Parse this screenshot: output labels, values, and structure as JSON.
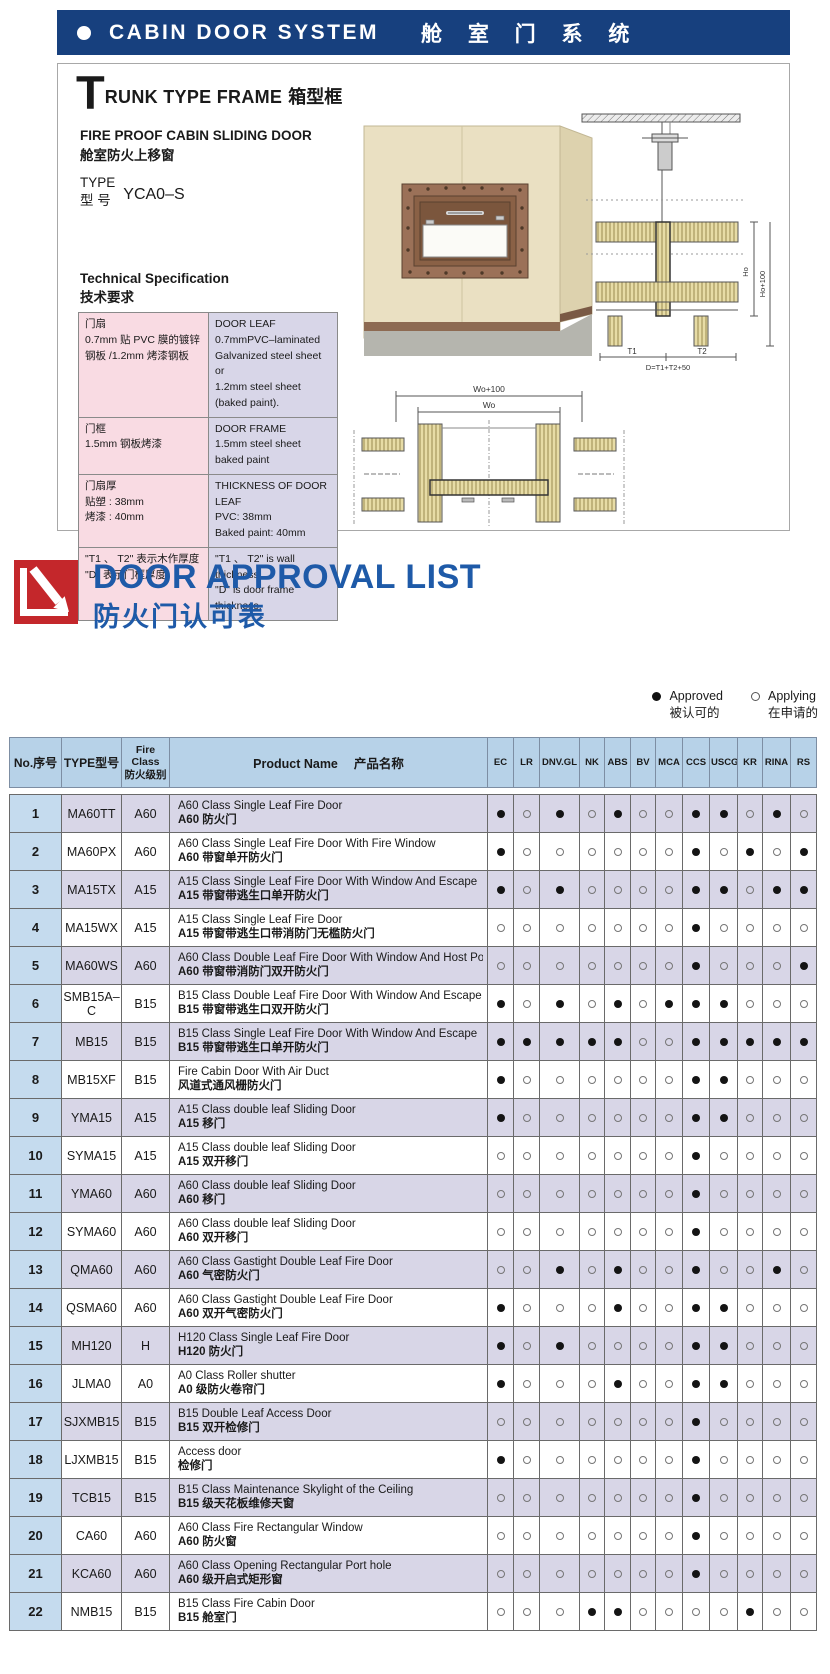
{
  "banner": {
    "title_en": "CABIN DOOR SYSTEM",
    "title_zh": "舱 室 门 系 统"
  },
  "trunk_section": {
    "title_initial": "T",
    "title_rest": "RUNK TYPE FRAME",
    "title_zh": "箱型框",
    "subtitle": "FIRE PROOF CABIN SLIDING DOOR\n舱室防火上移窗",
    "type_label": "TYPE\n型  号",
    "type_value": "YCA0–S",
    "tech_title": "Technical Specification\n技术要求",
    "spec_rows": [
      {
        "zh": "门扇\n0.7mm 贴 PVC 膜的镀锌\n钢板 /1.2mm 烤漆钢板",
        "en": "DOOR LEAF\n0.7mmPVC–laminated\nGalvanized steel sheet or\n1.2mm steel sheet\n(baked paint)."
      },
      {
        "zh": "门框\n1.5mm 钢板烤漆",
        "en": "DOOR FRAME\n1.5mm steel sheet baked paint"
      },
      {
        "zh": "门扇厚\n贴塑 : 38mm\n烤漆 : 40mm",
        "en": "THICKNESS OF DOOR LEAF\nPVC: 38mm\nBaked paint: 40mm"
      },
      {
        "zh": "\"T1 、 T2\" 表示木作厚度\n\"D\" 表示门框厚度",
        "en": "\"T1 、 T2\" is wall thickness;\n\"D\" is door frame thickness."
      }
    ],
    "drawing_labels": {
      "ho": "Ho",
      "ho_plus": "Ho+100",
      "t1": "T1",
      "t2": "T2",
      "d_formula": "D=T1+T2+50",
      "wo_plus": "Wo+100",
      "wo": "Wo"
    }
  },
  "approval_section": {
    "title_en": "DOOR APPROVAL LIST",
    "title_zh": "防火门认可表",
    "legend": {
      "approved_en": "Approved",
      "approved_zh": "被认可的",
      "applying_en": "Applying",
      "applying_zh": "在申请的"
    },
    "table": {
      "header_no": "No.序号",
      "header_type": "TYPE型号",
      "header_fire_class": "Fire\nClass\n防火级别",
      "header_product": "Product Name　 产品名称",
      "societies": [
        "EC",
        "LR",
        "DNV.GL",
        "NK",
        "ABS",
        "BV",
        "MCA",
        "CCS",
        "USCG",
        "KR",
        "RINA",
        "RS"
      ],
      "rows": [
        {
          "no": "1",
          "type": "MA60TT",
          "fire_class": "A60",
          "name_en": "A60 Class Single Leaf Fire Door",
          "name_zh": "A60 防火门",
          "approvals": [
            1,
            0,
            1,
            0,
            1,
            0,
            0,
            1,
            1,
            0,
            1,
            0
          ]
        },
        {
          "no": "2",
          "type": "MA60PX",
          "fire_class": "A60",
          "name_en": "A60 Class Single Leaf Fire Door With Fire Window",
          "name_zh": "A60 带窗单开防火门",
          "approvals": [
            1,
            0,
            0,
            0,
            0,
            0,
            0,
            1,
            0,
            1,
            0,
            1
          ]
        },
        {
          "no": "3",
          "type": "MA15TX",
          "fire_class": "A15",
          "name_en": "A15 Class Single Leaf Fire Door With Window And Escape",
          "name_zh": "A15 带窗带逃生口单开防火门",
          "approvals": [
            1,
            0,
            1,
            0,
            0,
            0,
            0,
            1,
            1,
            0,
            1,
            1
          ]
        },
        {
          "no": "4",
          "type": "MA15WX",
          "fire_class": "A15",
          "name_en": "A15 Class Single Leaf Fire Door",
          "name_zh": "A15 带窗带逃生口带消防门无槛防火门",
          "approvals": [
            0,
            0,
            0,
            0,
            0,
            0,
            0,
            1,
            0,
            0,
            0,
            0
          ]
        },
        {
          "no": "5",
          "type": "MA60WS",
          "fire_class": "A60",
          "name_en": "A60 Class Double Leaf Fire Door With Window And Host Port",
          "name_zh": "A60 带窗带消防门双开防火门",
          "approvals": [
            0,
            0,
            0,
            0,
            0,
            0,
            0,
            1,
            0,
            0,
            0,
            1
          ]
        },
        {
          "no": "6",
          "type": "SMB15A–C",
          "fire_class": "B15",
          "name_en": "B15 Class Double Leaf Fire Door With Window And Escape",
          "name_zh": "B15 带窗带逃生口双开防火门",
          "approvals": [
            1,
            0,
            1,
            0,
            1,
            0,
            1,
            1,
            1,
            0,
            0,
            0
          ]
        },
        {
          "no": "7",
          "type": "MB15",
          "fire_class": "B15",
          "name_en": "B15 Class Single Leaf Fire Door With Window And Escape",
          "name_zh": "B15 带窗带逃生口单开防火门",
          "approvals": [
            1,
            1,
            1,
            1,
            1,
            0,
            0,
            1,
            1,
            1,
            1,
            1
          ]
        },
        {
          "no": "8",
          "type": "MB15XF",
          "fire_class": "B15",
          "name_en": "Fire Cabin Door With Air Duct",
          "name_zh": "风道式通风栅防火门",
          "approvals": [
            1,
            0,
            0,
            0,
            0,
            0,
            0,
            1,
            1,
            0,
            0,
            0
          ]
        },
        {
          "no": "9",
          "type": "YMA15",
          "fire_class": "A15",
          "name_en": "A15 Class double leaf Sliding Door",
          "name_zh": "A15 移门",
          "approvals": [
            1,
            0,
            0,
            0,
            0,
            0,
            0,
            1,
            1,
            0,
            0,
            0
          ]
        },
        {
          "no": "10",
          "type": "SYMA15",
          "fire_class": "A15",
          "name_en": "A15 Class double leaf Sliding Door",
          "name_zh": "A15 双开移门",
          "approvals": [
            0,
            0,
            0,
            0,
            0,
            0,
            0,
            1,
            0,
            0,
            0,
            0
          ]
        },
        {
          "no": "11",
          "type": "YMA60",
          "fire_class": "A60",
          "name_en": "A60 Class double leaf Sliding Door",
          "name_zh": "A60 移门",
          "approvals": [
            0,
            0,
            0,
            0,
            0,
            0,
            0,
            1,
            0,
            0,
            0,
            0
          ]
        },
        {
          "no": "12",
          "type": "SYMA60",
          "fire_class": "A60",
          "name_en": "A60 Class double leaf Sliding Door",
          "name_zh": "A60 双开移门",
          "approvals": [
            0,
            0,
            0,
            0,
            0,
            0,
            0,
            1,
            0,
            0,
            0,
            0
          ]
        },
        {
          "no": "13",
          "type": "QMA60",
          "fire_class": "A60",
          "name_en": "A60 Class Gastight Double Leaf Fire Door",
          "name_zh": "A60 气密防火门",
          "approvals": [
            0,
            0,
            1,
            0,
            1,
            0,
            0,
            1,
            0,
            0,
            1,
            0
          ]
        },
        {
          "no": "14",
          "type": "QSMA60",
          "fire_class": "A60",
          "name_en": "A60 Class Gastight Double Leaf Fire Door",
          "name_zh": "A60 双开气密防火门",
          "approvals": [
            1,
            0,
            0,
            0,
            1,
            0,
            0,
            1,
            1,
            0,
            0,
            0
          ]
        },
        {
          "no": "15",
          "type": "MH120",
          "fire_class": "H",
          "name_en": "H120 Class Single Leaf Fire Door",
          "name_zh": "H120 防火门",
          "approvals": [
            1,
            0,
            1,
            0,
            0,
            0,
            0,
            1,
            1,
            0,
            0,
            0
          ]
        },
        {
          "no": "16",
          "type": "JLMA0",
          "fire_class": "A0",
          "name_en": "A0 Class Roller shutter",
          "name_zh": "A0 级防火卷帘门",
          "approvals": [
            1,
            0,
            0,
            0,
            1,
            0,
            0,
            1,
            1,
            0,
            0,
            0
          ]
        },
        {
          "no": "17",
          "type": "SJXMB15",
          "fire_class": "B15",
          "name_en": "B15  Double Leaf Access Door",
          "name_zh": "B15 双开检修门",
          "approvals": [
            0,
            0,
            0,
            0,
            0,
            0,
            0,
            1,
            0,
            0,
            0,
            0
          ]
        },
        {
          "no": "18",
          "type": "LJXMB15",
          "fire_class": "B15",
          "name_en": "Access door",
          "name_zh": "检修门",
          "approvals": [
            1,
            0,
            0,
            0,
            0,
            0,
            0,
            1,
            0,
            0,
            0,
            0
          ]
        },
        {
          "no": "19",
          "type": "TCB15",
          "fire_class": "B15",
          "name_en": "B15 Class Maintenance Skylight of the Ceiling",
          "name_zh": "B15 级天花板维修天窗",
          "approvals": [
            0,
            0,
            0,
            0,
            0,
            0,
            0,
            1,
            0,
            0,
            0,
            0
          ]
        },
        {
          "no": "20",
          "type": "CA60",
          "fire_class": "A60",
          "name_en": "A60 Class Fire Rectangular Window",
          "name_zh": "A60 防火窗",
          "approvals": [
            0,
            0,
            0,
            0,
            0,
            0,
            0,
            1,
            0,
            0,
            0,
            0
          ]
        },
        {
          "no": "21",
          "type": "KCA60",
          "fire_class": "A60",
          "name_en": "A60 Class  Opening Rectangular Port hole",
          "name_zh": "A60 级开启式矩形窗",
          "approvals": [
            0,
            0,
            0,
            0,
            0,
            0,
            0,
            1,
            0,
            0,
            0,
            0
          ]
        },
        {
          "no": "22",
          "type": "NMB15",
          "fire_class": "B15",
          "name_en": "B15 Class Fire Cabin Door",
          "name_zh": "B15 舱室门",
          "approvals": [
            0,
            0,
            0,
            1,
            1,
            0,
            0,
            0,
            0,
            1,
            0,
            0
          ]
        }
      ]
    }
  },
  "colors": {
    "banner_blue": "#17407e",
    "approval_blue": "#1e5aa8",
    "logo_red": "#c4272b",
    "table_header_blue": "#b7d2e8",
    "row_shade_lavender": "#d8d6e7",
    "spec_pink": "#f9dbe3",
    "spec_lavender": "#d8d6e8"
  }
}
